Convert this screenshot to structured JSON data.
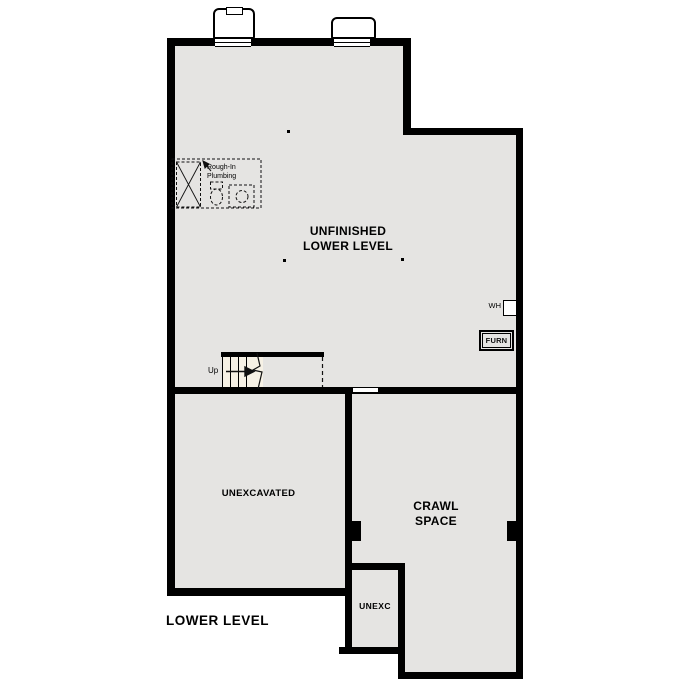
{
  "plan": {
    "title": "LOWER LEVEL",
    "type_note": "architectural lower level floor plan"
  },
  "colors": {
    "wall": "#000000",
    "floor_fill": "#e5e4e2",
    "stair_fill": "#f6f1e5",
    "background": "#ffffff"
  },
  "rooms": {
    "unfinished_lower_level": {
      "line1": "UNFINISHED",
      "line2": "LOWER LEVEL"
    },
    "unexcavated": {
      "label": "UNEXCAVATED"
    },
    "crawl_space": {
      "line1": "CRAWL",
      "line2": "SPACE"
    },
    "unexc": {
      "label": "UNEXC"
    }
  },
  "annotations": {
    "rough_in": {
      "line1": "Rough-In",
      "line2": "Plumbing"
    },
    "stairs_up": "Up",
    "water_heater": "WH",
    "furnace": "FURN"
  }
}
